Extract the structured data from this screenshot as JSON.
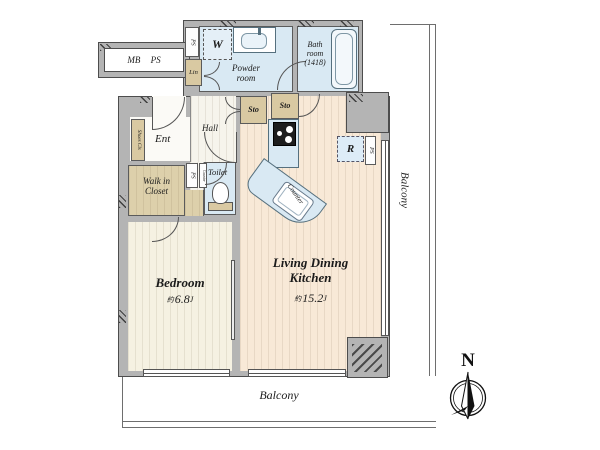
{
  "plan": {
    "compass_n": "N",
    "balcony_right": "Balcony",
    "balcony_bottom": "Balcony",
    "mb_ps": "MB PS",
    "ps": "PS",
    "washer": "W",
    "lin": "Lin",
    "sto": "Sto",
    "powder": {
      "l1": "Powder",
      "l2": "room"
    },
    "bath": {
      "l1": "Bath",
      "l2": "room",
      "l3": "(1418)"
    },
    "hall": "Hall",
    "ent": "Ent",
    "shoes": "Shoes Cls",
    "wic": {
      "l1": "Walk in",
      "l2": "Closet"
    },
    "toilet": "Toilet",
    "fridge": "R",
    "counter": "Counter",
    "bedroom": {
      "name": "Bedroom",
      "approx": "約",
      "area": "6.8",
      "unit": "J"
    },
    "ldk": {
      "l1": "Living Dining",
      "l2": "Kitchen",
      "approx": "約",
      "area": "15.2",
      "unit": "J"
    }
  },
  "colors": {
    "wall": "#b4b4b4",
    "wet_room": "#d9e9f3",
    "storage": "#d9c9a2",
    "ldk_floor": "#f8e9d7",
    "bedroom_floor": "#f5f1e2",
    "hall_floor": "#f6f4ec"
  }
}
